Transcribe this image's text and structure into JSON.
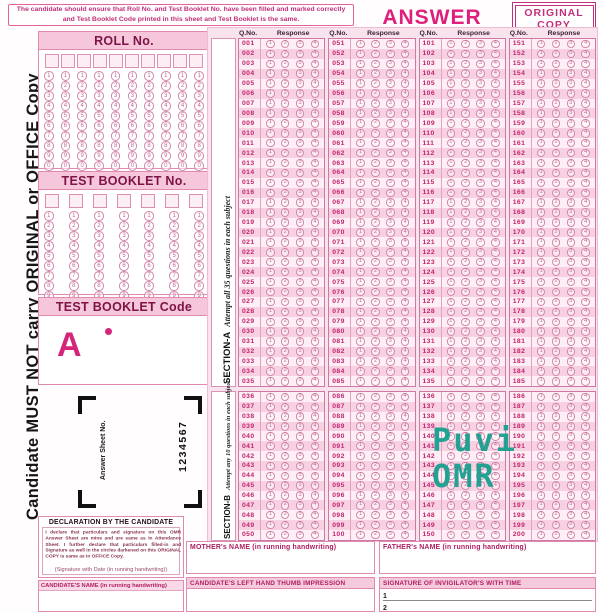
{
  "colors": {
    "accent_magenta": "#e01f7d",
    "dark_magenta": "#7d1347",
    "pink_row": "#f7d0e2",
    "pink_light": "#fdeff5",
    "watermark_teal": "#139e8c"
  },
  "header": {
    "instruction": "The candidate should ensure that Roll No. and Test Booklet No. have been filled and marked correctly and Test Booklet Code printed in this sheet and Test Booklet is the same.",
    "title": "ANSWER SHEET",
    "copy_badge_line1": "ORIGINAL",
    "copy_badge_line2": "COPY"
  },
  "left_strip": {
    "text": "Candidate MUST NOT carry ORIGINAL or OFFICE Copy"
  },
  "roll_panel": {
    "title": "ROLL No.",
    "columns": 10,
    "row_digits": [
      "1",
      "2",
      "3",
      "4",
      "5",
      "6",
      "7",
      "8",
      "9",
      "0"
    ]
  },
  "booklet_panel": {
    "title": "TEST BOOKLET No.",
    "columns": 7,
    "row_digits": [
      "1",
      "2",
      "3",
      "4",
      "5",
      "6",
      "7",
      "8",
      "9",
      "0"
    ]
  },
  "code_panel": {
    "title": "TEST BOOKLET Code",
    "code": "A"
  },
  "answer_sheet_no": {
    "label": "Answer Sheet No.",
    "number": "1234567"
  },
  "declaration": {
    "title": "DECLARATION BY THE CANDIDATE",
    "body": "I declare that particulars and signature on this OMR Answer Sheet are mine and are same as in Attendance Sheet. I further declare that particulars filled-in and Signature as well in the circles darkened on this ORIGINAL COPY is same as in OFFICE Copy.",
    "signature_label": "(Signature with Date (in running handwriting))"
  },
  "candidate_name_label": "CANDIDATE'S NAME (in running handwriting)",
  "answer_grid": {
    "qno_header": "Q.No.",
    "response_header": "Response",
    "options": [
      "1",
      "2",
      "3",
      "4"
    ],
    "group_starts": [
      1,
      51,
      101,
      151
    ],
    "section_a": {
      "label": "SECTION-A",
      "note": "Attempt all 35 questions in each subject",
      "questions_per_group": 35
    },
    "section_b": {
      "label": "SECTION-B",
      "note": "Attempt any 10 questions in each subject",
      "questions_per_group": 15
    }
  },
  "watermark": {
    "line1": "Puvi",
    "line2": "OMR"
  },
  "bottom": {
    "mother_label": "MOTHER's NAME (in running handwriting)",
    "father_label": "FATHER's NAME (in running handwriting)",
    "thumb_label": "CANDIDATE'S LEFT HAND THUMB IMPRESSION",
    "invigilator_label": "SIGNATURE OF INVIGILATOR'S WITH TIME",
    "signature_rows": [
      "1",
      "2"
    ]
  }
}
